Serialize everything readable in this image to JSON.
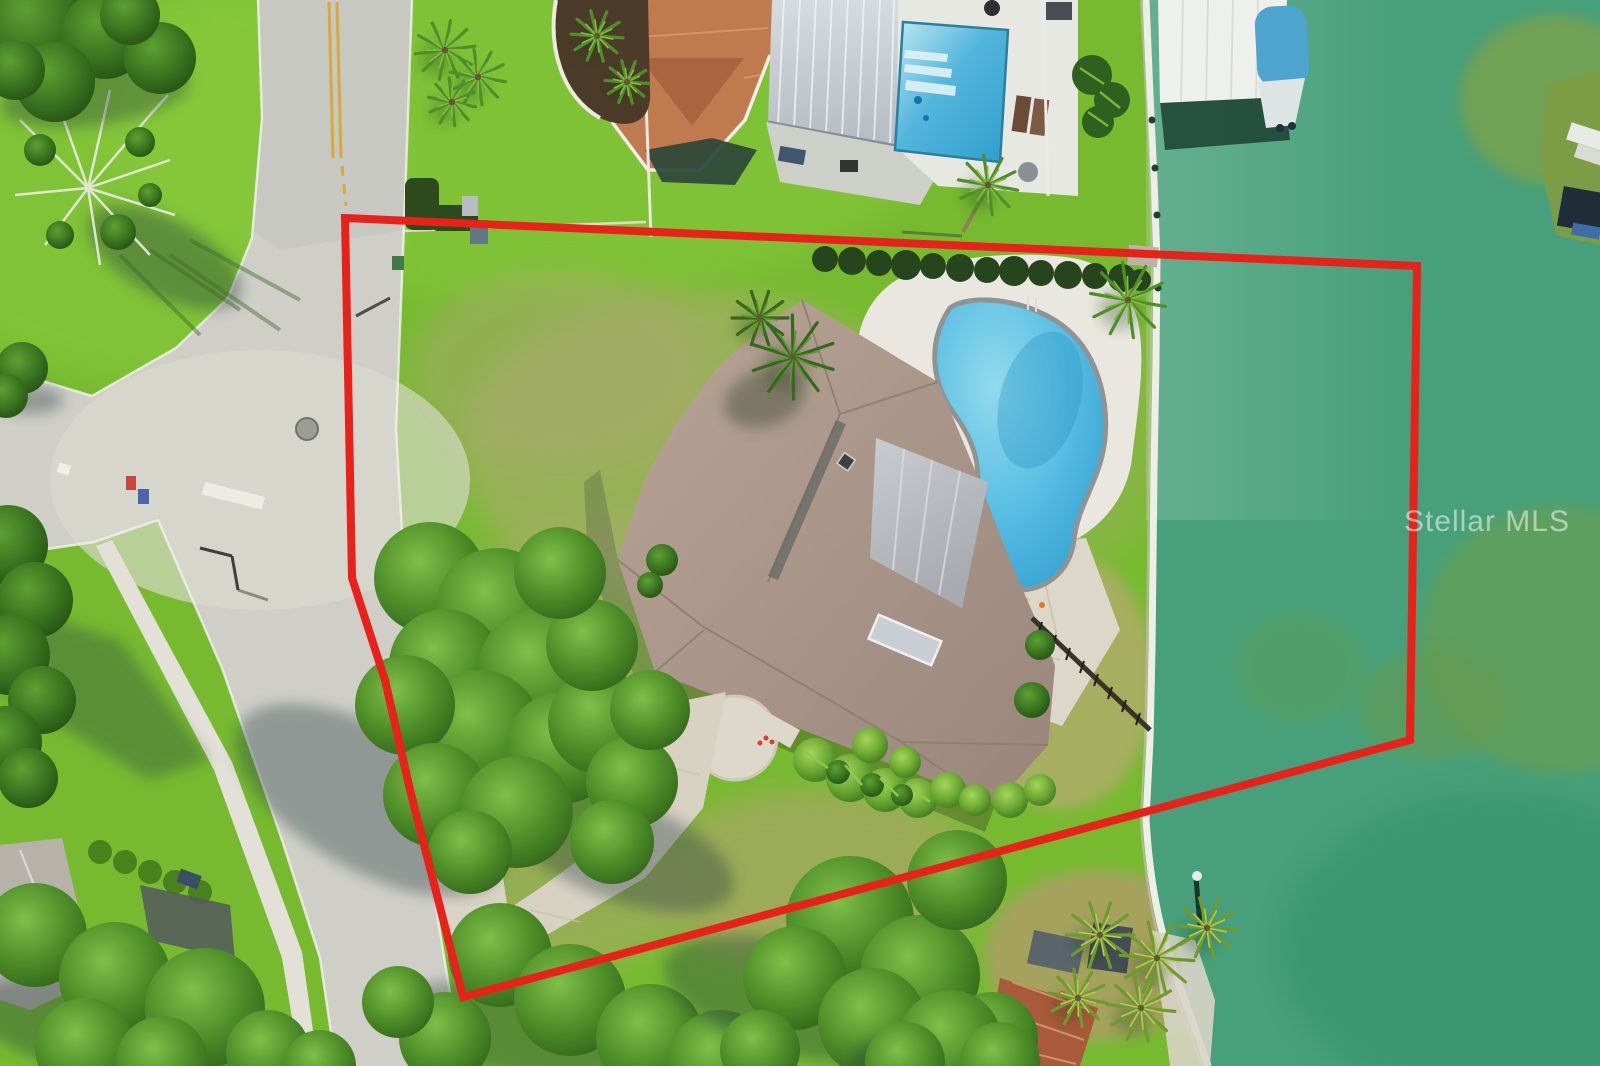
{
  "meta": {
    "kind": "aerial-photograph",
    "description": "Overhead drone photo of a waterfront residential lot outlined in red: subject house with kidney-shaped pool, vacant side yard, neighboring homes with pools and boat dock, curving streets with grass median, and a green canal."
  },
  "watermark": {
    "text": "Stellar MLS"
  },
  "colors": {
    "boundary_red": "#e8211a",
    "water": "#47a07b",
    "grass": "#77ba30",
    "dry_grass": "#b3a974",
    "road": "#cfcfc8",
    "sidewalk": "#e3e1d7",
    "subject_roof": "#ab9789",
    "porch_roof": "#b7bac0",
    "neighbor_tile_roof": "#bf7a50",
    "neighbor_metal_roof": "#c8ced4",
    "pool_water": "#45b0dc",
    "pool_deck": "#e9e7df",
    "tree_green": "#4e8e28",
    "seawall_white": "#edeee6",
    "boat_canopy_blue": "#4da4cf",
    "road_marking_yellow": "#d9a93c"
  }
}
